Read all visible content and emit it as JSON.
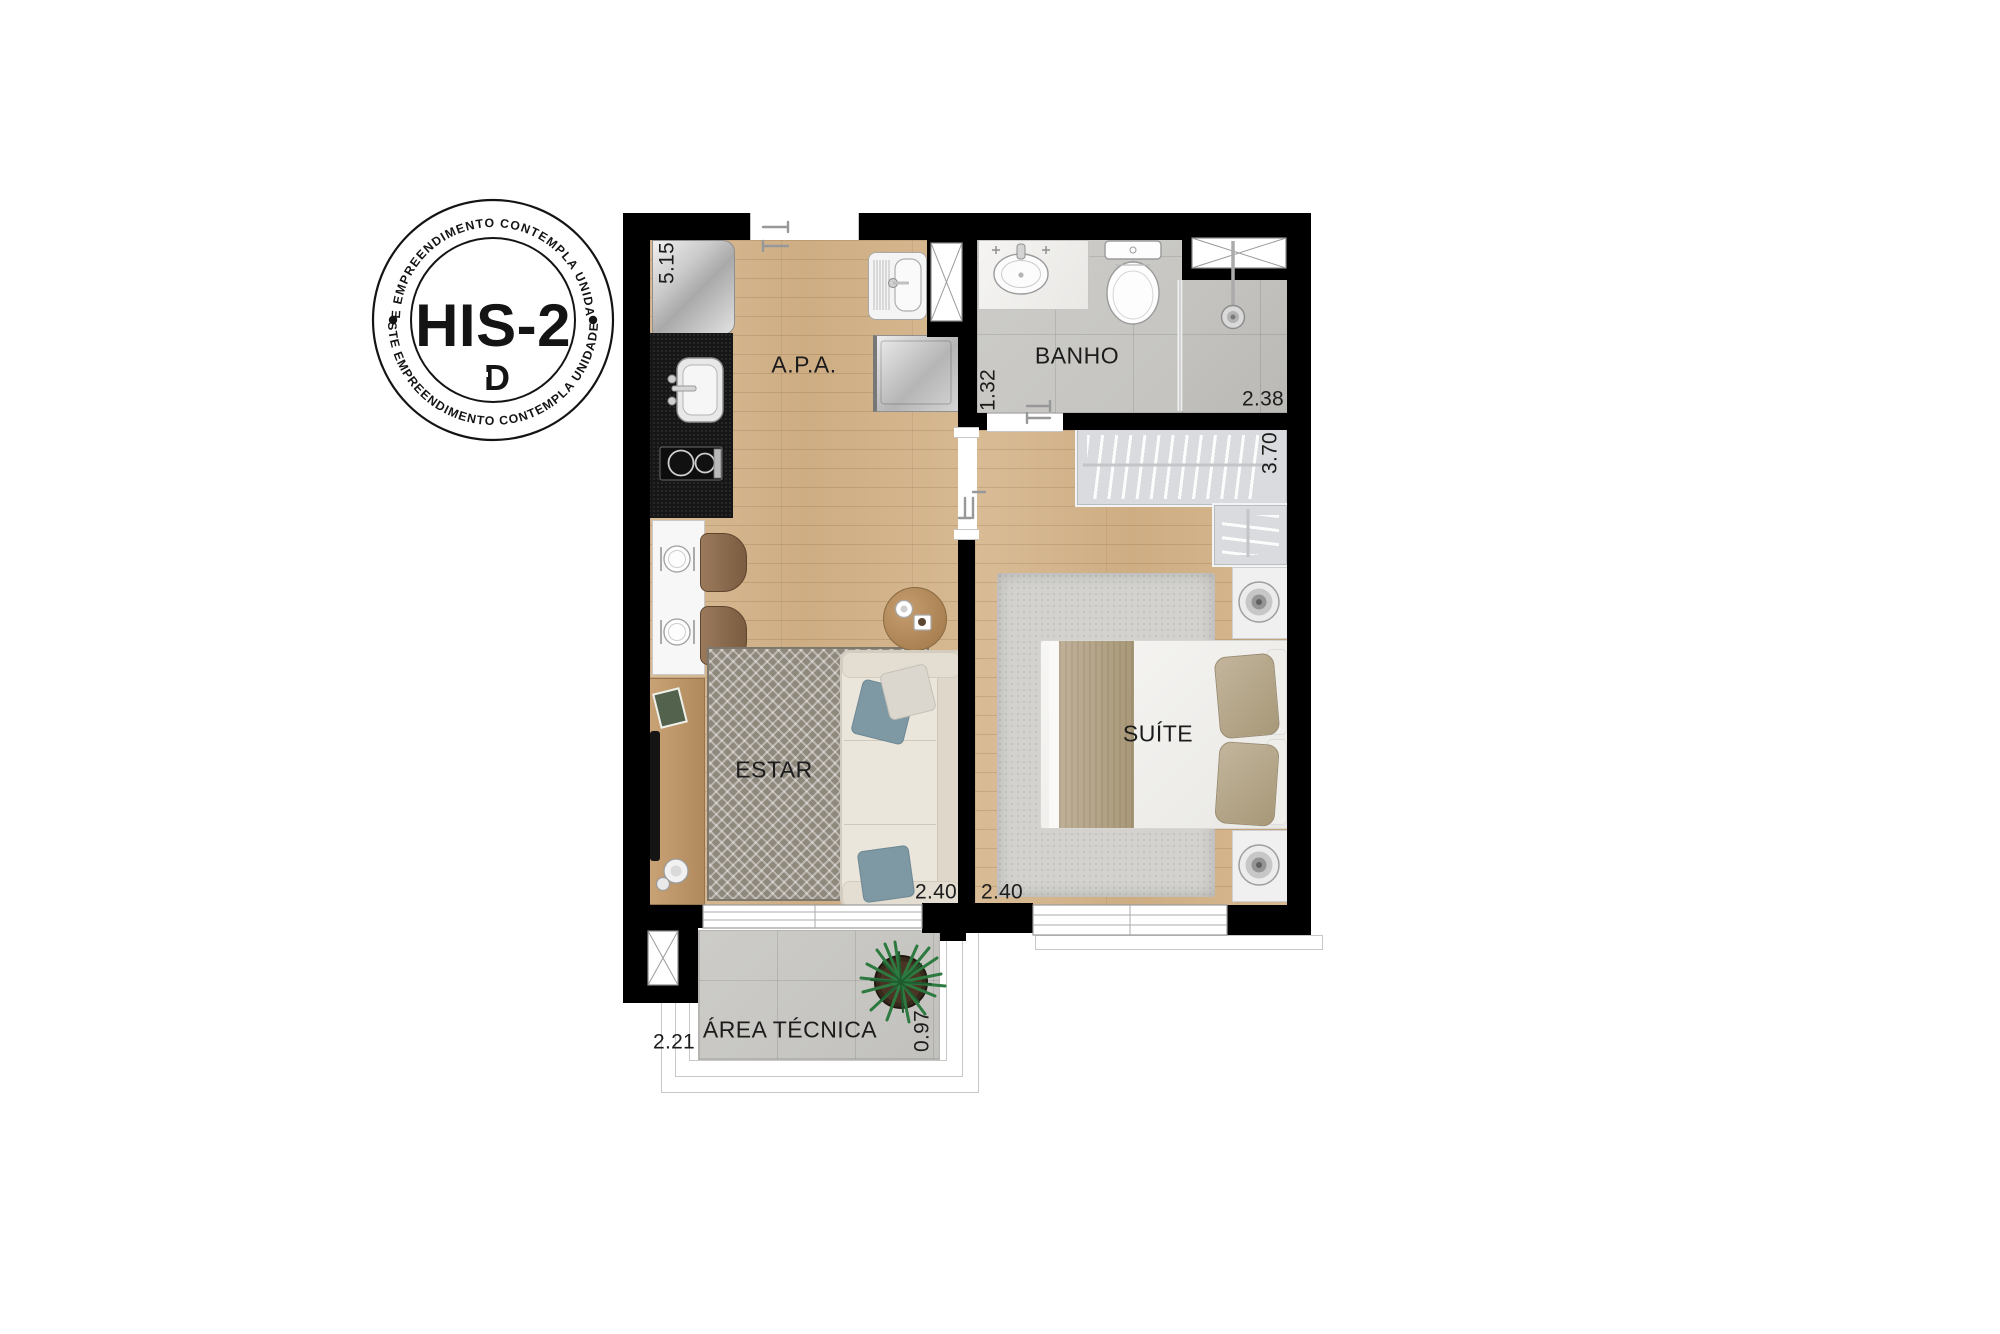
{
  "badge": {
    "arc_text_top": "ESTE EMPREENDIMENTO CONTEMPLA UNIDADES",
    "arc_text_bottom": "ESTE EMPREENDIMENTO CONTEMPLA UNIDADES",
    "unit_code": "HIS-2",
    "logo_letter": "D",
    "ink_color": "#141414"
  },
  "floor_plan": {
    "room_labels": {
      "apa": "A.P.A.",
      "banho": "BANHO",
      "suite": "SUÍTE",
      "estar": "ESTAR",
      "area_tecnica": "ÁREA TÉCNICA"
    },
    "dimensions": {
      "apa_length": "5.15",
      "banho_width": "1.32",
      "shower_length": "2.38",
      "closet_length": "3.70",
      "estar_width": "2.40",
      "suite_width": "2.40",
      "area_tecnica_length": "2.21",
      "area_tecnica_width": "0.97"
    },
    "colors": {
      "wall": "#000000",
      "wood_floor": "#d2b48c",
      "tile_floor": "#c9c8c4",
      "accent_pillow_blue": "#7e99a3"
    }
  }
}
